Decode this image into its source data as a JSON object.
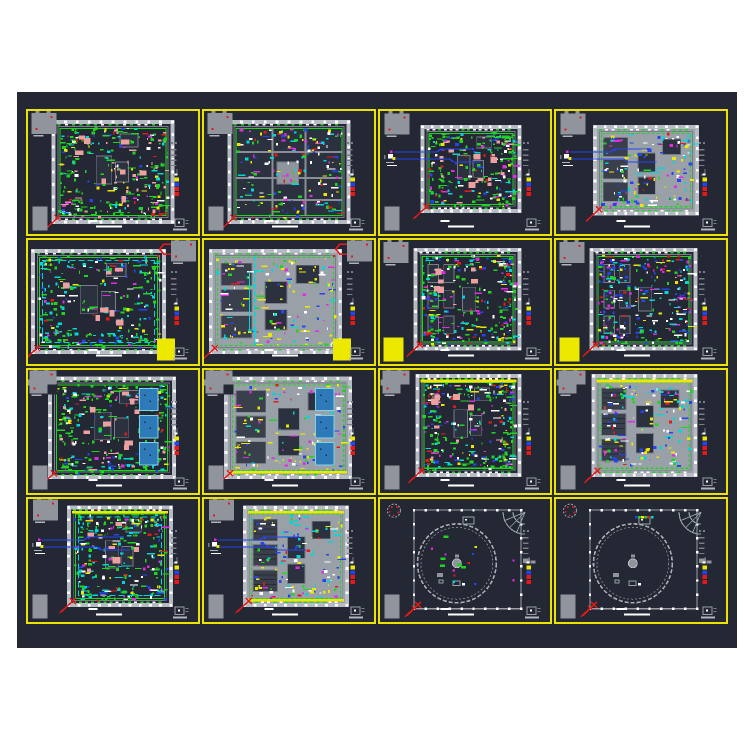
{
  "view": {
    "kind": "cad-model-space",
    "sheet_grid": {
      "rows": 4,
      "cols": 4
    }
  },
  "colors": {
    "page": "#ffffff",
    "canvas": "#232834",
    "grid": "#eee200",
    "wall": "#b6bac2",
    "wallDim": "#787d87",
    "blockGray": "#90949c",
    "roomDark": "#2c3140",
    "interiorLight": "#9aa0a8",
    "white": "#ffffff",
    "green": "#21d421",
    "cyan": "#00d8d8",
    "blue": "#2743f0",
    "magenta": "#e02ce0",
    "red": "#e61919",
    "yellow": "#ece800",
    "salmon": "#eda0a0",
    "pool": "#2e7ab8",
    "poolEdge": "#7cd4e8"
  },
  "stack_colors": [
    "#ece800",
    "#2743f0",
    "#e61919",
    "#e61919"
  ],
  "palettes": {
    "greenPink": [
      [
        "green",
        46
      ],
      [
        "cyan",
        14
      ],
      [
        "salmon",
        10
      ],
      [
        "white",
        8
      ],
      [
        "blue",
        7
      ],
      [
        "magenta",
        5
      ],
      [
        "yellow",
        5
      ],
      [
        "red",
        5
      ]
    ],
    "greenCyan": [
      [
        "green",
        40
      ],
      [
        "cyan",
        24
      ],
      [
        "white",
        10
      ],
      [
        "blue",
        8
      ],
      [
        "magenta",
        6
      ],
      [
        "yellow",
        7
      ],
      [
        "red",
        5
      ]
    ],
    "greenMulti": [
      [
        "green",
        34
      ],
      [
        "cyan",
        16
      ],
      [
        "magenta",
        10
      ],
      [
        "blue",
        10
      ],
      [
        "white",
        10
      ],
      [
        "yellow",
        8
      ],
      [
        "red",
        7
      ],
      [
        "salmon",
        5
      ]
    ],
    "blueMulti": [
      [
        "blue",
        26
      ],
      [
        "cyan",
        20
      ],
      [
        "magenta",
        14
      ],
      [
        "white",
        12
      ],
      [
        "green",
        14
      ],
      [
        "yellow",
        9
      ],
      [
        "red",
        5
      ]
    ],
    "grayYellow": [
      [
        "yellow",
        28
      ],
      [
        "white",
        18
      ],
      [
        "blue",
        14
      ],
      [
        "cyan",
        14
      ],
      [
        "magenta",
        10
      ],
      [
        "green",
        11
      ],
      [
        "red",
        5
      ]
    ],
    "grayBlue": [
      [
        "cyan",
        22
      ],
      [
        "yellow",
        18
      ],
      [
        "blue",
        20
      ],
      [
        "white",
        16
      ],
      [
        "green",
        12
      ],
      [
        "magenta",
        8
      ],
      [
        "red",
        4
      ]
    ],
    "roomsMix": [
      [
        "yellow",
        18
      ],
      [
        "green",
        20
      ],
      [
        "magenta",
        12
      ],
      [
        "blue",
        14
      ],
      [
        "white",
        16
      ],
      [
        "cyan",
        12
      ],
      [
        "red",
        8
      ]
    ]
  },
  "cells": [
    {
      "id": "r1c1",
      "variant": "dense",
      "palette": "greenPink",
      "plan": [
        0.15,
        0.09,
        0.7,
        0.81
      ],
      "block": "rect",
      "blockPos": [
        0.02,
        0.015
      ],
      "clutter": 300,
      "salmon": 8,
      "grayBL": 1
    },
    {
      "id": "r1c2",
      "variant": "rooms",
      "palette": "roomsMix",
      "plan": [
        0.15,
        0.09,
        0.7,
        0.81
      ],
      "block": "rect",
      "blockPos": [
        0.02,
        0.015
      ],
      "clutter": 180,
      "grayBL": 1
    },
    {
      "id": "r1c3",
      "variant": "dense",
      "palette": "greenPink",
      "plan": [
        0.25,
        0.13,
        0.57,
        0.68
      ],
      "block": "rect",
      "blockPos": [
        0.025,
        0.02
      ],
      "clutter": 240,
      "salmon": 6,
      "grayBL": 1,
      "fragment": 1,
      "blueLine": 1
    },
    {
      "id": "r1c4",
      "variant": "sparse",
      "palette": "grayBlue",
      "plan": [
        0.23,
        0.13,
        0.6,
        0.7
      ],
      "block": "rect",
      "blockPos": [
        0.025,
        0.02
      ],
      "clutter": 140,
      "grayBL": 1,
      "fragment": 1,
      "blueLine": 1
    },
    {
      "id": "r2c1",
      "variant": "dense",
      "palette": "greenCyan",
      "plan": [
        0.03,
        0.09,
        0.77,
        0.82
      ],
      "block": "rect",
      "blockPos": [
        0.84,
        0.005
      ],
      "clutter": 300,
      "salmon": 7,
      "c1": 1,
      "yellowRect": "br"
    },
    {
      "id": "r2c2",
      "variant": "sparse",
      "palette": "grayYellow",
      "plan": [
        0.04,
        0.09,
        0.76,
        0.82
      ],
      "block": "rect",
      "blockPos": [
        0.84,
        0.005
      ],
      "clutter": 160,
      "c1": 1,
      "yellowRect": "br",
      "cyanV": 1
    },
    {
      "id": "r2c3",
      "variant": "dense",
      "palette": "greenMulti",
      "plan": [
        0.21,
        0.08,
        0.61,
        0.8
      ],
      "block": "rect",
      "blockPos": [
        0.02,
        0.015
      ],
      "clutter": 280,
      "salmon": 6,
      "yellowRect": "bl",
      "vStripes": 1
    },
    {
      "id": "r2c4",
      "variant": "dense",
      "palette": "blueMulti",
      "plan": [
        0.21,
        0.08,
        0.61,
        0.8
      ],
      "block": "rect",
      "blockPos": [
        0.02,
        0.015
      ],
      "clutter": 280,
      "yellowRect": "bl",
      "vStripes": 1
    },
    {
      "id": "r3c1",
      "variant": "dense",
      "palette": "greenPink",
      "plan": [
        0.13,
        0.07,
        0.73,
        0.8
      ],
      "block": "jagged",
      "blockPos": [
        0.01,
        0.005
      ],
      "clutter": 300,
      "salmon": 8,
      "grayBL": 1,
      "pools": 1
    },
    {
      "id": "r3c2",
      "variant": "sparse",
      "palette": "grayYellow",
      "plan": [
        0.13,
        0.07,
        0.73,
        0.8
      ],
      "block": "jagged",
      "blockPos": [
        0.01,
        0.005
      ],
      "clutter": 140,
      "grayBL": 1,
      "pools": 1,
      "yellowBarBottom": 1
    },
    {
      "id": "r3c3",
      "variant": "dense",
      "palette": "greenMulti",
      "plan": [
        0.22,
        0.05,
        0.6,
        0.8
      ],
      "block": "jagged",
      "blockPos": [
        0.015,
        0.005
      ],
      "clutter": 290,
      "salmon": 6,
      "grayBL": 1,
      "yellowBarTop": 1
    },
    {
      "id": "r3c4",
      "variant": "sparse",
      "palette": "grayBlue",
      "plan": [
        0.22,
        0.05,
        0.6,
        0.8
      ],
      "block": "jagged",
      "blockPos": [
        0.015,
        0.005
      ],
      "clutter": 160,
      "grayBL": 1,
      "yellowBarTop": 1,
      "darkRooms": 1
    },
    {
      "id": "r4c1",
      "variant": "dense",
      "palette": "greenCyan",
      "plan": [
        0.24,
        0.07,
        0.6,
        0.79
      ],
      "block": "rect",
      "blockPos": [
        0.03,
        0.005
      ],
      "clutter": 280,
      "salmon": 6,
      "grayBL": 1,
      "fragment": 1,
      "blueLine": 1,
      "yellowBarTop": 1
    },
    {
      "id": "r4c2",
      "variant": "sparse",
      "palette": "grayBlue",
      "plan": [
        0.24,
        0.07,
        0.6,
        0.79
      ],
      "block": "rect",
      "blockPos": [
        0.03,
        0.005
      ],
      "clutter": 130,
      "grayBL": 1,
      "fragment": 1,
      "blueLine": 1,
      "yellowBarTop": 1,
      "yellowBarBottom": 1,
      "darkRooms": 1
    },
    {
      "id": "r4c3",
      "variant": "circular",
      "palette": "greenMulti",
      "plan": [
        0.2,
        0.09,
        0.63,
        0.8
      ],
      "block": "circle",
      "blockPos": [
        0.035,
        0.03
      ],
      "grayBL": 1,
      "marks": 14
    },
    {
      "id": "r4c4",
      "variant": "circular",
      "palette": "greenMulti",
      "plan": [
        0.2,
        0.09,
        0.63,
        0.8
      ],
      "block": "circle",
      "blockPos": [
        0.035,
        0.03
      ],
      "grayBL": 1,
      "marks": 0,
      "colorbar": 1
    }
  ]
}
